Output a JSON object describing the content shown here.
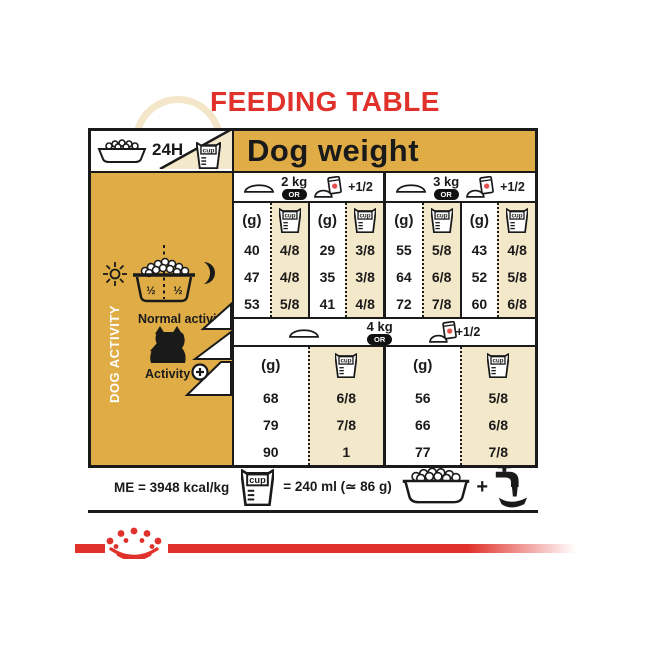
{
  "title": "FEEDING TABLE",
  "colors": {
    "red": "#E0312A",
    "gold": "#DFAC45",
    "tan": "#F4E8CA",
    "ink": "#1A1A1A"
  },
  "header": {
    "duration": "24H",
    "dog_weight": "Dog weight"
  },
  "labels": {
    "grams": "(g)",
    "cup": "cup",
    "or": "OR",
    "plus_half": "+1/2",
    "plus": "+"
  },
  "sidebar": {
    "vertical": "DOG ACTIVITY",
    "bowl_left": "½",
    "bowl_right": "½",
    "normal": "Normal activity",
    "active": "Activity"
  },
  "groups": [
    {
      "weight": "2 kg",
      "columns": [
        {
          "values": [
            "40",
            "47",
            "53"
          ]
        },
        {
          "values": [
            "4/8",
            "4/8",
            "5/8"
          ]
        },
        {
          "values": [
            "29",
            "35",
            "41"
          ]
        },
        {
          "values": [
            "3/8",
            "3/8",
            "4/8"
          ]
        }
      ]
    },
    {
      "weight": "3 kg",
      "columns": [
        {
          "values": [
            "55",
            "64",
            "72"
          ]
        },
        {
          "values": [
            "5/8",
            "6/8",
            "7/8"
          ]
        },
        {
          "values": [
            "43",
            "52",
            "60"
          ]
        },
        {
          "values": [
            "4/8",
            "5/8",
            "6/8"
          ]
        }
      ]
    },
    {
      "weight": "4 kg",
      "columns": [
        {
          "values": [
            "68",
            "79",
            "90"
          ]
        },
        {
          "values": [
            "6/8",
            "7/8",
            "1"
          ]
        },
        {
          "values": [
            "56",
            "66",
            "77"
          ]
        },
        {
          "values": [
            "5/8",
            "6/8",
            "7/8"
          ]
        }
      ]
    }
  ],
  "footer": {
    "me": "ME = 3948 kcal/kg",
    "equiv": "= 240 ml (≃ 86 g)"
  }
}
